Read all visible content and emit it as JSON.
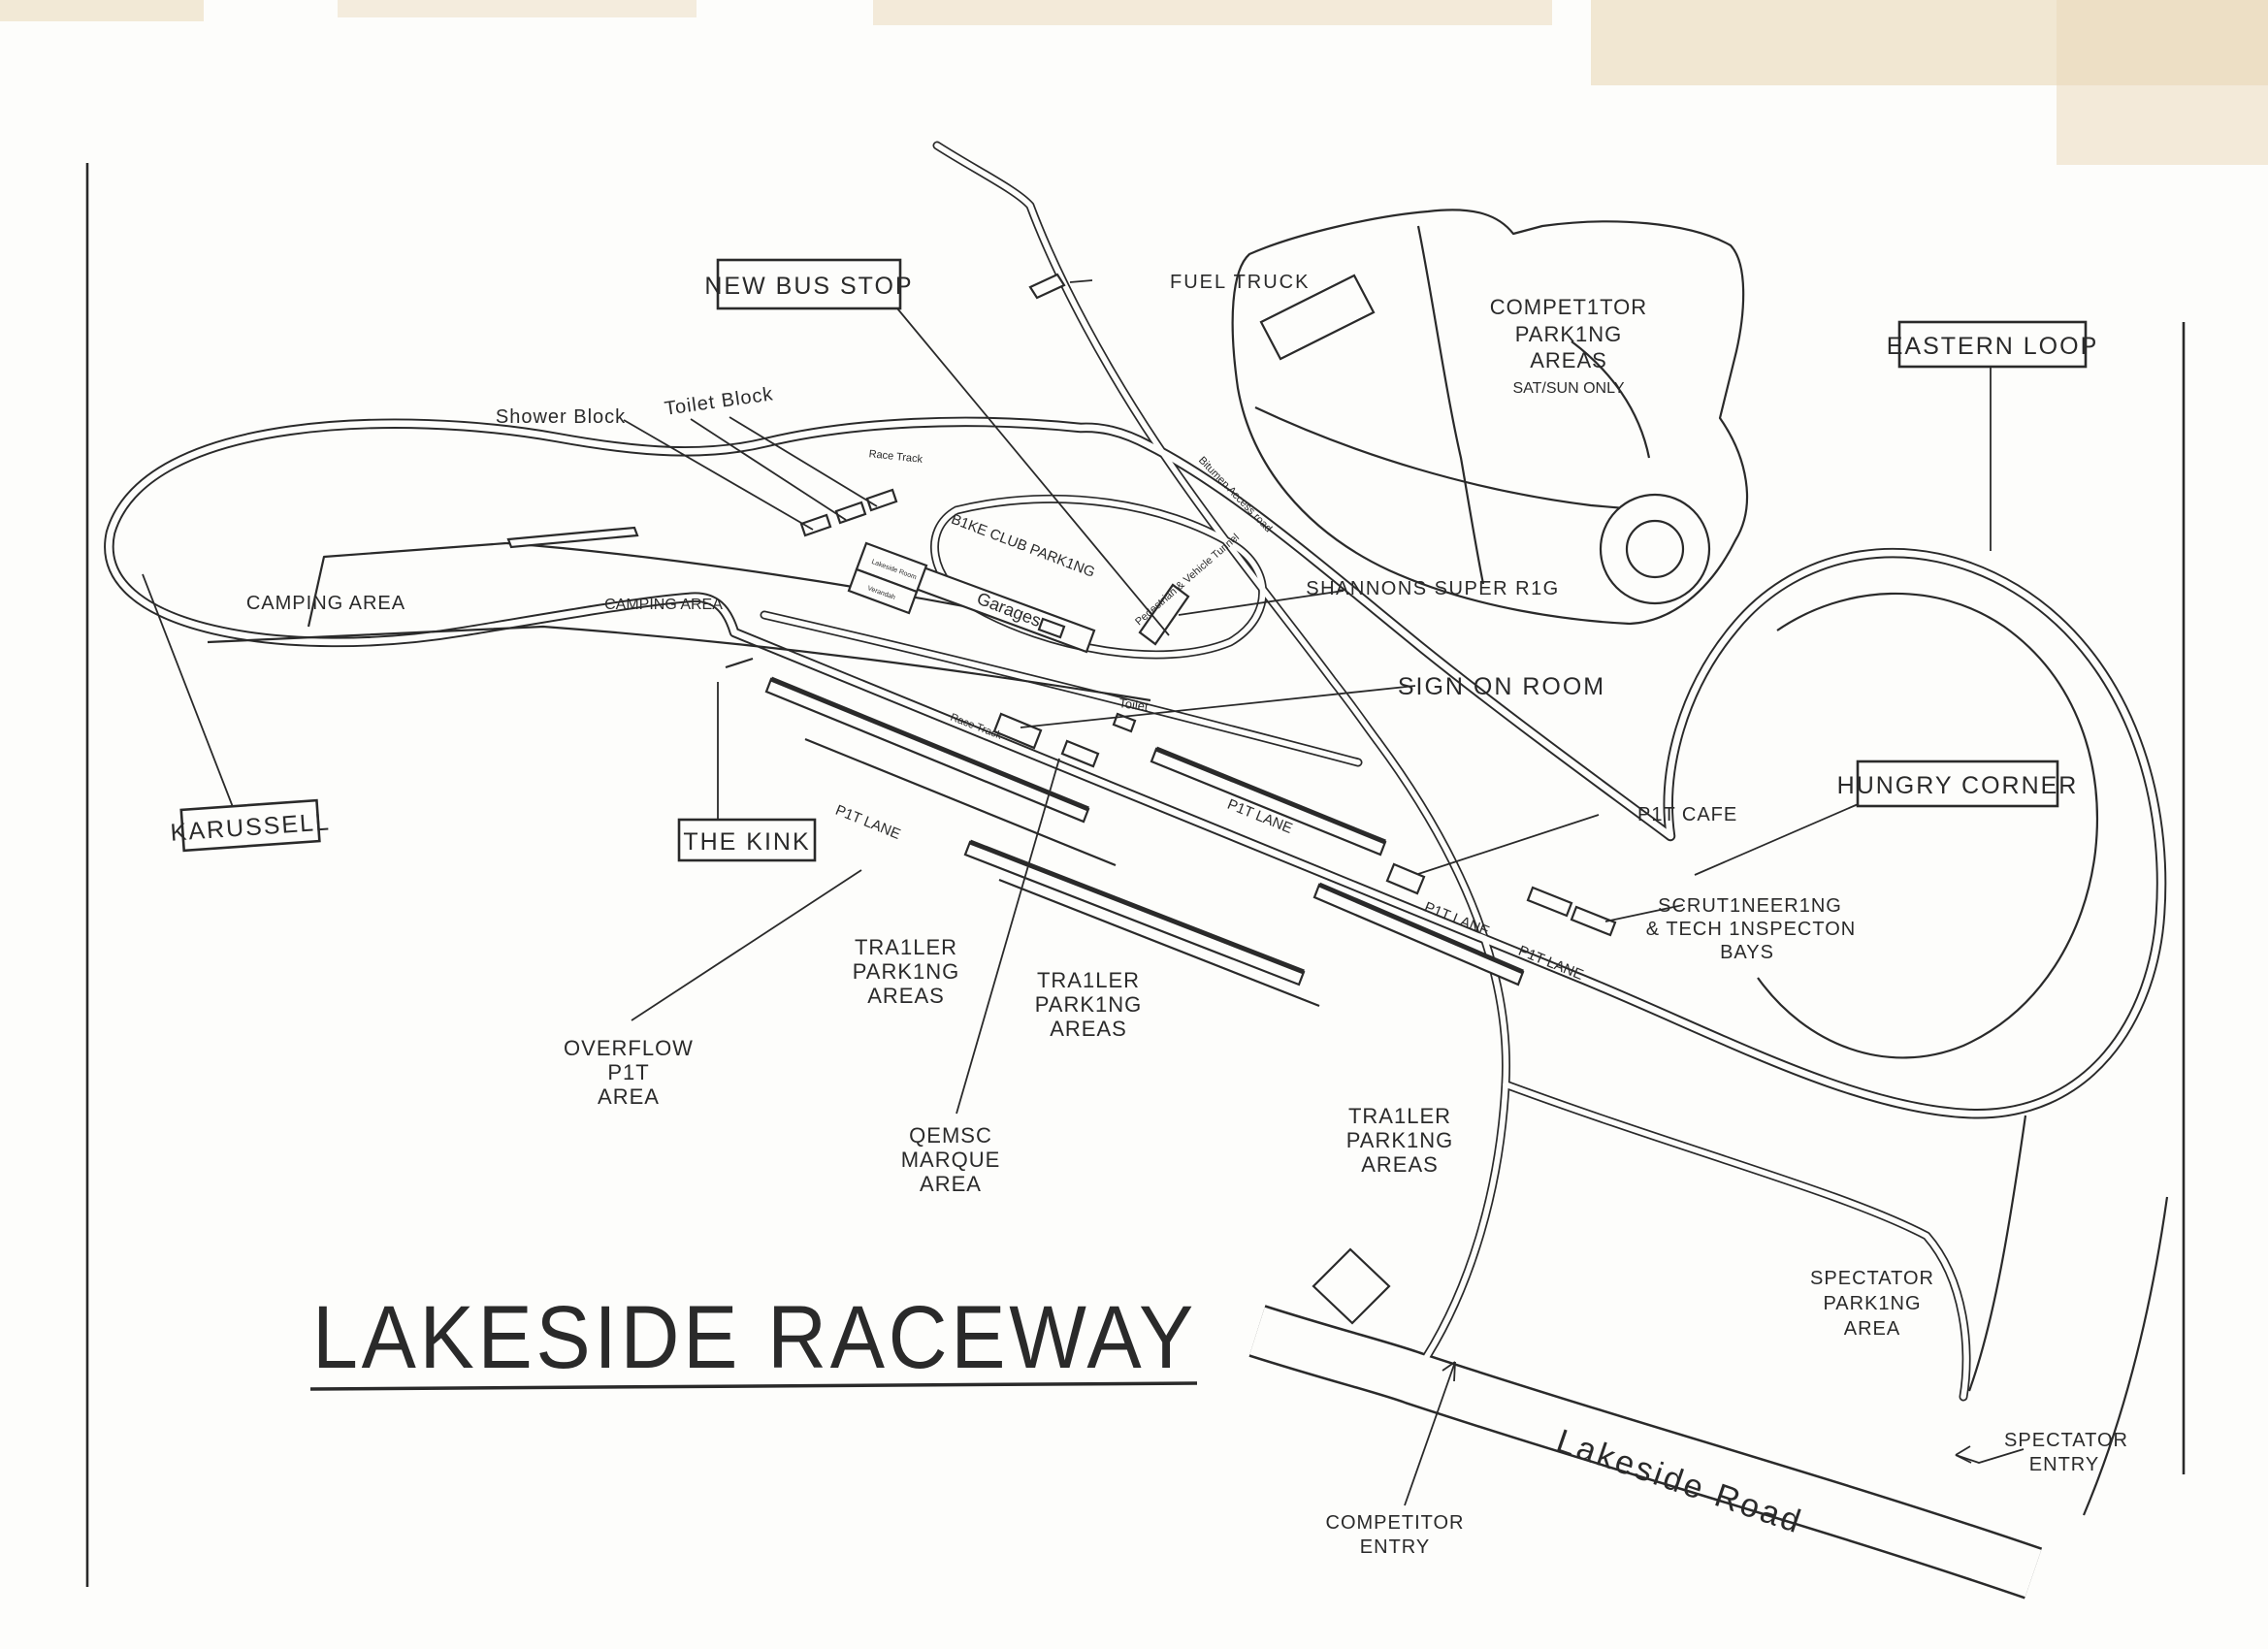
{
  "page": {
    "title": "LAKESIDE RACEWAY"
  },
  "colors": {
    "ink": "#2a2a2a",
    "paper": "#fdfdfb",
    "scan_artifact": "#e9d8b8"
  },
  "boxed": {
    "new_bus_stop": "NEW BUS STOP",
    "eastern_loop": "EASTERN LOOP",
    "karussell": "KARUSSELL",
    "the_kink": "THE KINK",
    "hungry_corner": "HUNGRY CORNER"
  },
  "labels": {
    "fuel_truck": "FUEL TRUCK",
    "toilet_block": "Toilet Block",
    "shower_block": "Shower Block",
    "camping_area_west": "CAMPING AREA",
    "camping_area_east": "CAMPING AREA",
    "race_track_north": "Race Track",
    "race_track_main": "Race Track",
    "bike_club_parking": "B1KE CLUB PARK1NG",
    "garages": "Garages",
    "lakeside_room": "Lakeside Room",
    "verandah": "Verandah",
    "bitumen_access_road": "Bitumen Access road",
    "pedestrian_vehicle_tunnel": "Pedestrian & Vehicle Tunnel",
    "shannons_super_rig": "SHANNONS SUPER R1G",
    "sign_on_room": "SIGN ON ROOM",
    "toilet": "Toilet",
    "pit_lane": "P1T LANE",
    "pit_cafe": "P1T CAFE",
    "scrutineering_line1": "SCRUT1NEER1NG",
    "scrutineering_line2": "& TECH 1NSPECTON",
    "scrutineering_line3": "BAYS",
    "trailer_line1": "TRA1LER",
    "trailer_line2": "PARK1NG",
    "trailer_line3": "AREAS",
    "overflow_line1": "OVERFLOW",
    "overflow_line2": "P1T",
    "overflow_line3": "AREA",
    "qemsc_line1": "QEMSC",
    "qemsc_line2": "MARQUE",
    "qemsc_line3": "AREA",
    "competitor_parking_line1": "COMPET1TOR",
    "competitor_parking_line2": "PARK1NG",
    "competitor_parking_line3": "AREAS",
    "competitor_parking_line4": "SAT/SUN ONLY",
    "spectator_parking_line1": "SPECTATOR",
    "spectator_parking_line2": "PARK1NG",
    "spectator_parking_line3": "AREA",
    "competitor_entry_line1": "COMPETITOR",
    "competitor_entry_line2": "ENTRY",
    "spectator_entry_line1": "SPECTATOR",
    "spectator_entry_line2": "ENTRY",
    "lakeside_road": "Lakeside Road"
  }
}
